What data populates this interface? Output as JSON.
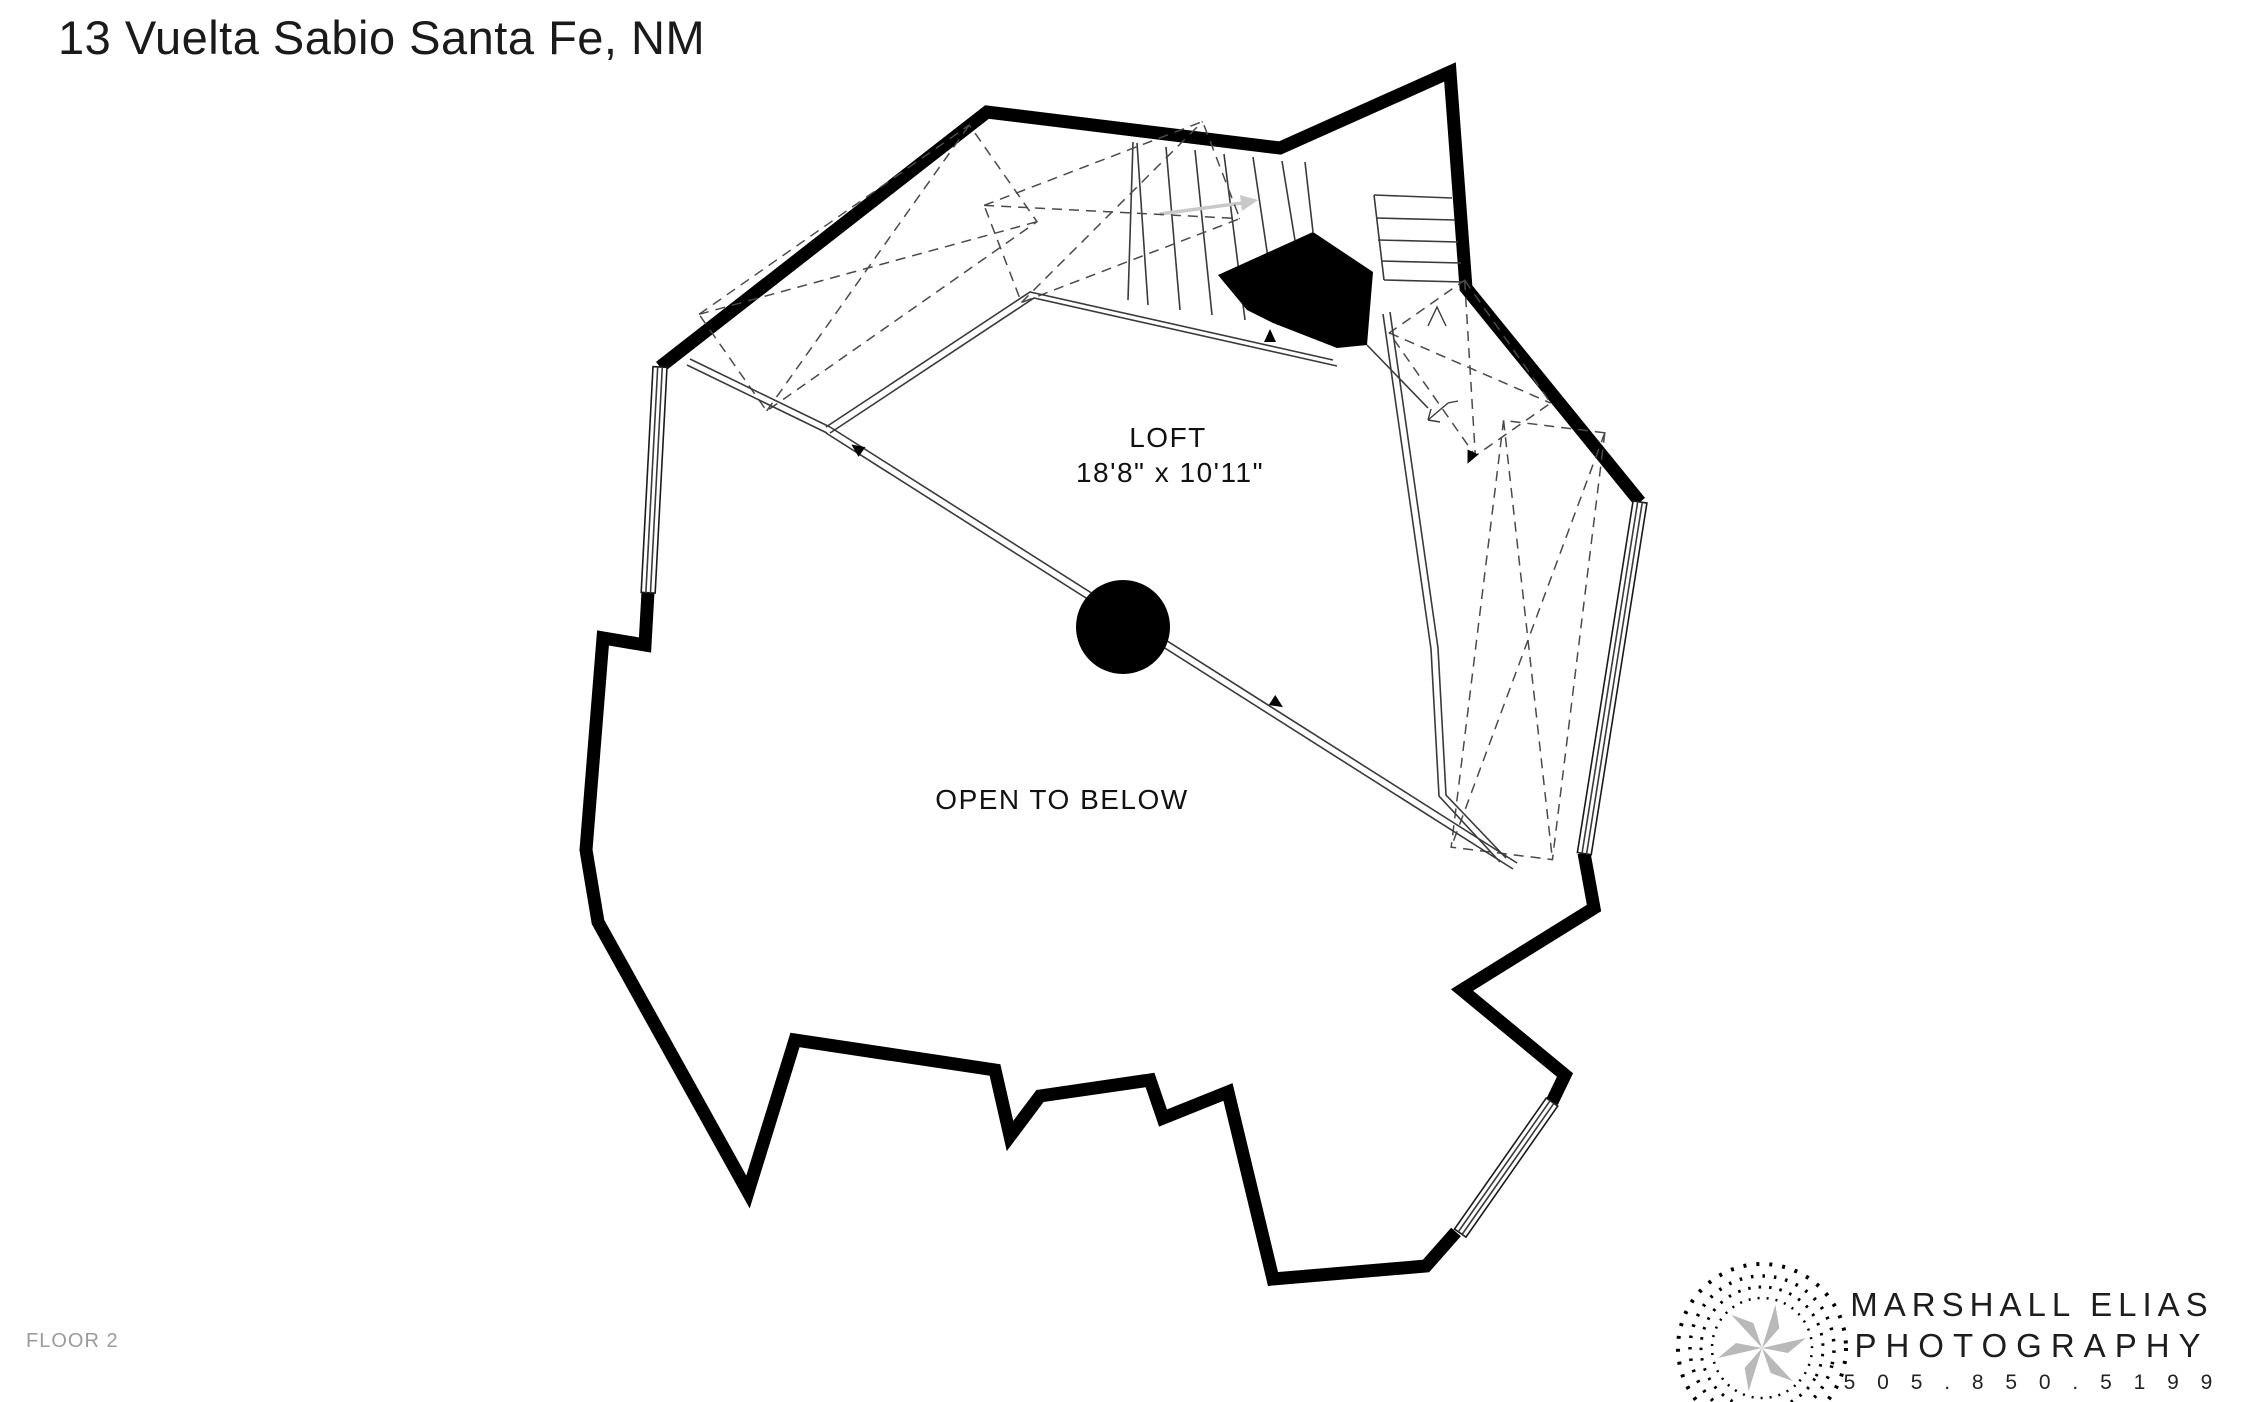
{
  "header": {
    "title": "13 Vuelta Sabio Santa Fe, NM"
  },
  "plan": {
    "room_label": "LOFT",
    "room_dimensions": "18'8\" x 10'11\"",
    "open_label": "OPEN TO BELOW"
  },
  "footer": {
    "floor_label": "FLOOR 2"
  },
  "logo": {
    "name": "MARSHALL ELIAS",
    "type": "PHOTOGRAPHY",
    "phone": "5 0 5 . 8 5 0 . 5 1 9 9"
  },
  "colors": {
    "wall": "#000000",
    "line": "#3a3a3a",
    "dash": "#4a4a4a",
    "stair_arrow": "#c9c9c9",
    "logo_gray": "#b9b9b9",
    "muted_text": "#9b9b9b",
    "text": "#1a1a1a"
  }
}
